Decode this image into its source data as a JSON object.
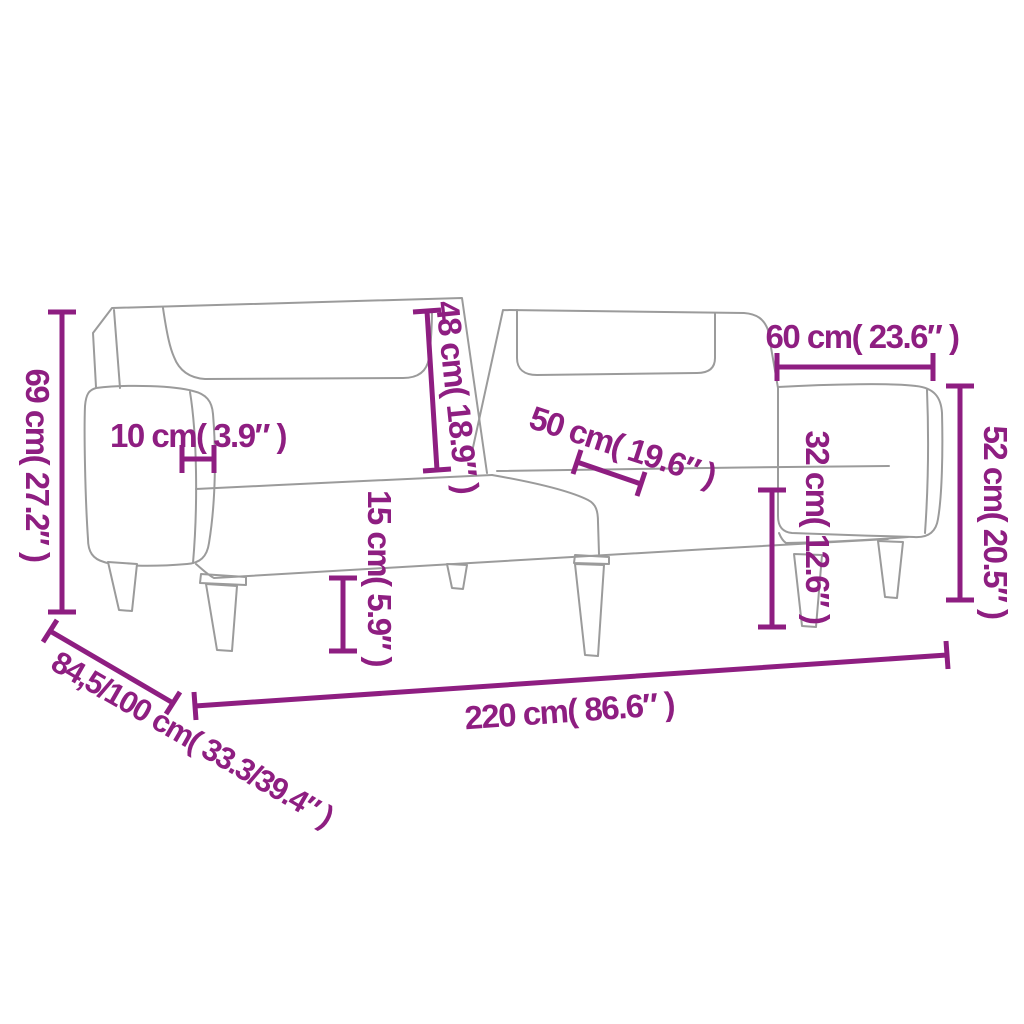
{
  "diagram": {
    "kind": "product-dimension-diagram",
    "subject": "sofa-bed-with-chaise-line-drawing",
    "style": {
      "accent_color": "#8E1E81",
      "drawing_line_color": "#9B9B9B",
      "background_color": "#FFFFFF"
    },
    "measurements": [
      {
        "id": "overall-height",
        "text": "69 cm( 27.2″ )"
      },
      {
        "id": "armrest-width",
        "text": "10 cm( 3.9″ )"
      },
      {
        "id": "backrest-height",
        "text": "48 cm( 18.9″ )"
      },
      {
        "id": "seat-width",
        "text": "50 cm( 19.6″ )"
      },
      {
        "id": "chaise-length",
        "text": "60 cm( 23.6″ )"
      },
      {
        "id": "chaise-height",
        "text": "52 cm( 20.5″ )"
      },
      {
        "id": "seat-height",
        "text": "32 cm( 12.6″ )"
      },
      {
        "id": "leg-height",
        "text": "15 cm( 5.9″ )"
      },
      {
        "id": "overall-length",
        "text": "220 cm( 86.6″ )"
      },
      {
        "id": "overall-depth",
        "text": "84,5/100 cm( 33.3/39.4″ )"
      }
    ]
  }
}
